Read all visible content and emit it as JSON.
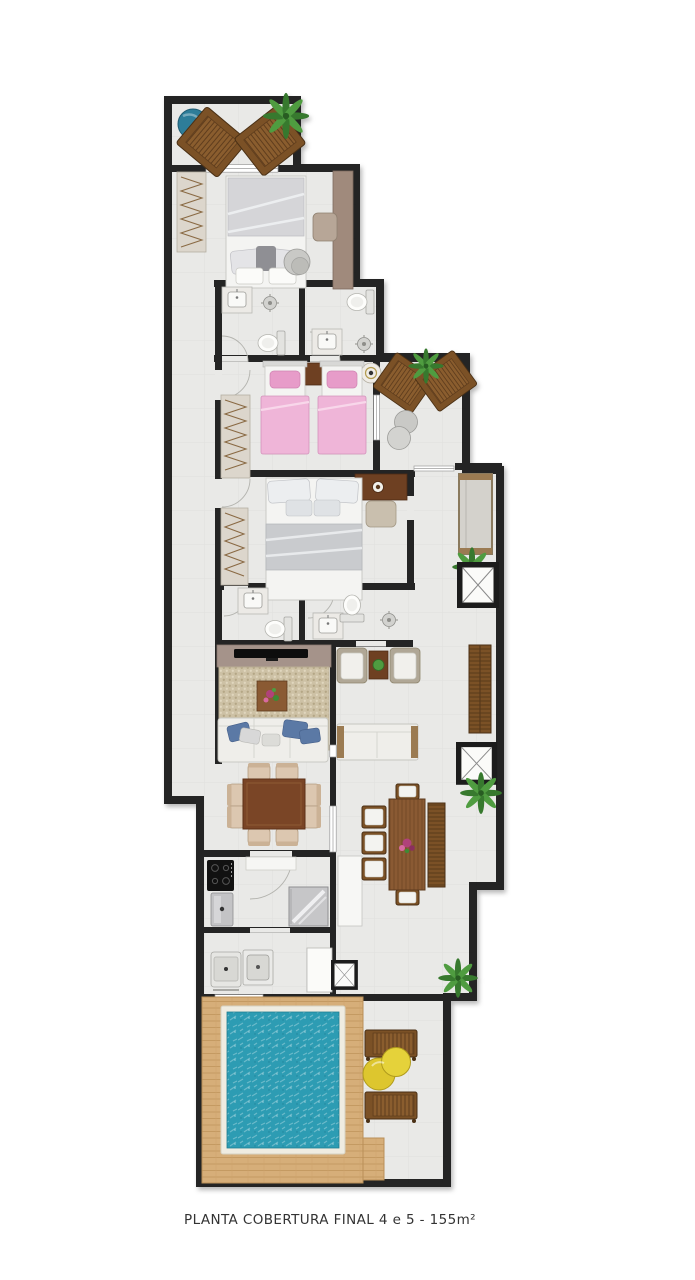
{
  "plan": {
    "caption": "PLANTA COBERTURA FINAL 4 e 5 - 155m²",
    "type": "penthouse-floor-plan",
    "symbols": [
      "sun-lounger",
      "palm-plant",
      "round-pouf",
      "double-bed",
      "single-bed-pink",
      "wardrobe",
      "toilet",
      "sink",
      "shower-head",
      "tv-panel",
      "sofa",
      "armchair",
      "coffee-table",
      "dining-table-8-chairs",
      "outdoor-dining-table",
      "bench",
      "elevator-shaft",
      "duct-shaft",
      "cooktop",
      "refrigerator",
      "washer",
      "laundry-tub",
      "pool",
      "wood-deck",
      "yellow-pouf"
    ]
  },
  "colors": {
    "wall": "#242424",
    "floor": "#e9e9e7",
    "wood_deck": "#d6ae79",
    "wood_frame": "#7b5126",
    "wood_mid": "#8a5a33",
    "wood_dark": "#6e4022",
    "pool_water": "#2d9cb3",
    "pool_border": "#efece1",
    "bed_pink": "#efb5d8",
    "bed_pink_deep": "#e79cc9",
    "rug_beige": "#cdc1a5",
    "sofa_white": "#efeeea",
    "pillow_blue": "#5b79a5",
    "pouf_yellow": "#ddc62e",
    "pouf_blue": "#2e7d99",
    "plant_green": "#3f8a35",
    "tv_panel": "#a5938a",
    "caption": "#333333"
  }
}
